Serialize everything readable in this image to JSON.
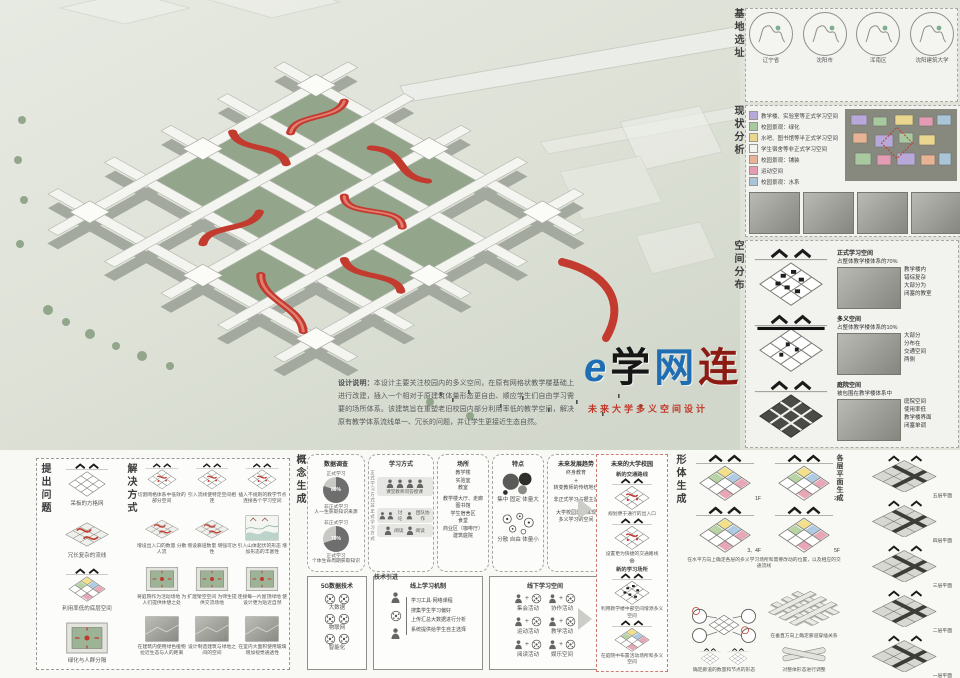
{
  "logo": {
    "char_e": "e",
    "char_xue": "学",
    "char_wang": "网",
    "char_lian": "连",
    "subtitle": "未来大学多义空间设计"
  },
  "description": {
    "title": "设计说明：",
    "body": "本设计主要关注校园内的多义空间，在原有网格状教学楼基础上进行改建，插入一个相对于原建筑体量形态更自由、顺应学生们自由学习需要的场所体系。该建筑旨在重塑老旧校园内部分利用率低的教学空间，解决原有教学体系流线单一、冗长的问题，并让学生更接近生态自然。"
  },
  "site": {
    "label": "基地选址",
    "maps": [
      {
        "caption": "辽宁省"
      },
      {
        "caption": "沈阳市"
      },
      {
        "caption": "浑南区"
      },
      {
        "caption": "沈阳建筑大学"
      }
    ]
  },
  "analysis": {
    "label": "现状分析",
    "legend": [
      {
        "color": "#b8a7d9",
        "text": "教学楼、实验室等正式学习空间"
      },
      {
        "color": "#a8c8a0",
        "text": "校园景观：绿化"
      },
      {
        "color": "#e9d68f",
        "text": "水吧、图书馆等半正式学习空间"
      },
      {
        "color": "#f2f2ee",
        "text": "学生宿舍等非正式学习空间"
      },
      {
        "color": "#e7b394",
        "text": "校园景观：铺装"
      },
      {
        "color": "#e39cb4",
        "text": "运动空间"
      },
      {
        "color": "#a9c6d8",
        "text": "校园景观：水系"
      }
    ]
  },
  "distribution": {
    "label": "空间分布",
    "rows": [
      {
        "title": "正式学习空间",
        "subtitle": "占整体教学楼体系的70%",
        "notes": [
          "教学楼内",
          "错综复杂",
          "大部分为",
          "闭塞的教室"
        ]
      },
      {
        "title": "多义空间",
        "subtitle": "占整体教学楼体系的10%",
        "notes": [
          "大部分",
          "分布在",
          "交通空间",
          "两侧"
        ]
      },
      {
        "title": "庭院空间",
        "subtitle": "被包围在教学楼体系中",
        "notes": [
          "庭院空间",
          "使用率低",
          "教学楼界面",
          "闭塞单调"
        ]
      }
    ]
  },
  "problem": {
    "label": "提出问题",
    "items": [
      "呆板的方格网",
      "冗长复杂的流线",
      "利用率低的底层空间",
      "绿化与人群分隔"
    ]
  },
  "solution": {
    "label": "解决方式",
    "items": [
      "切割网格体系中低效的部分空间",
      "引入流线使特定空间相连",
      "插入不规则的教学节点 连接各个学习空间",
      "增设出入口的数量 分散人流",
      "增设廊道数量 增强可达性",
      "引入山体起伏的形态 增加形态的丰富性",
      "将庭院作为活动场地 为人们提供休憩之处",
      "扩建架空空间 为师生提供交流场地",
      "连接每一片屋顶绿地 使设计更为贴近自然",
      "在建筑内使用绿色植物 拉近生态与人的距离",
      "设计制造建筑与绿地之间的空间",
      "在室内大面积使用玻璃 增加视觉通透性"
    ]
  },
  "concept": {
    "label": "概念生成",
    "survey": {
      "title": "数据调查",
      "pies": [
        {
          "caption": "人一生获取知识来源",
          "pct_label": "80%",
          "dark_value": 80,
          "side_top": "正式学习",
          "side_bottom": "非正式学习",
          "slices": [
            {
              "label": "正式学习",
              "value": 20
            },
            {
              "label": "非正式学习",
              "value": 80
            }
          ]
        },
        {
          "caption": "个体生命周期获取知识",
          "pct_label": "70%",
          "dark_value": 70,
          "side_top": "非正式学习",
          "side_bottom": "正式学习",
          "slices": [
            {
              "label": "正式学习",
              "value": 70
            },
            {
              "label": "非正式学习",
              "value": 30
            }
          ]
        }
      ]
    },
    "methods": {
      "title": "学习方式",
      "formal_label": "正式学习方式",
      "informal_label": "非正式学习方式",
      "row1": "课堂教师问答授课",
      "row2a": "讨论",
      "row2b": "团队协作",
      "row3a": "阅读",
      "row3b": "阅读"
    },
    "places": {
      "title": "场所",
      "formal": [
        "教学楼",
        "实验室",
        "教室"
      ],
      "informal": [
        "教学楼大厅、走廊",
        "图书馆",
        "学生宿舍区",
        "食堂",
        "商业区（咖啡厅）",
        "建筑庭院"
      ]
    },
    "traits": {
      "title": "特点",
      "formal": "集中 固定 体量大",
      "informal": "分散 自由 体量小"
    },
    "trends": {
      "title": "未来发展趋势",
      "t1": "终身教育",
      "t2": "+",
      "t3": "转变教师的传统地位",
      "t4": "非正式学习占据主流",
      "t5": "大学校园需要体现",
      "t6": "多义学习的空间"
    },
    "future": {
      "title": "未来的大学校园",
      "s1": "新的交通路线",
      "c1": "规划便于通行的出入口",
      "c2": "设置更为快捷的交通路线",
      "plus": "⊕",
      "s2": "新的学习场所",
      "c3": "利用教学楼中部空间增添多义空间",
      "c4": "在庭院中布置活动场所和多义空间"
    }
  },
  "tech": {
    "label": "技术引进",
    "box1": {
      "title": "5G数据技术",
      "items": [
        "大数据",
        "物联网",
        "智能化"
      ]
    },
    "box2": {
      "title": "线上学习机制",
      "items": [
        "学习工具·网络课程",
        "搜集学生学习偏好",
        "上传汇总大数据进行分析",
        "系统提供给学生自主选择"
      ]
    },
    "box3": {
      "title": "线下学习空间",
      "items": [
        "集会活动",
        "协作活动",
        "运动活动",
        "教学活动",
        "阅读活动",
        "娱乐空间"
      ]
    }
  },
  "form": {
    "label": "形体生成",
    "plans": [
      "1F",
      "2F",
      "3、4F",
      "5F"
    ],
    "caption": "在水平方向上确定各层的多义学习场所和需要改动的位置，以及相应的交通流线",
    "steps": [
      "确定廊道的数量和节点的形态",
      "在垂直方向上确定廊道穿插关系",
      "对整体形态进行调整"
    ]
  },
  "floors": {
    "label": "各层平面生成",
    "items": [
      "五层平面",
      "四层平面",
      "三层平面",
      "二层平面",
      "一层平面"
    ]
  },
  "colors": {
    "accent_red": "#c0392b",
    "logo_blue": "#1f6eb4",
    "logo_dark_red": "#8c1c13"
  }
}
